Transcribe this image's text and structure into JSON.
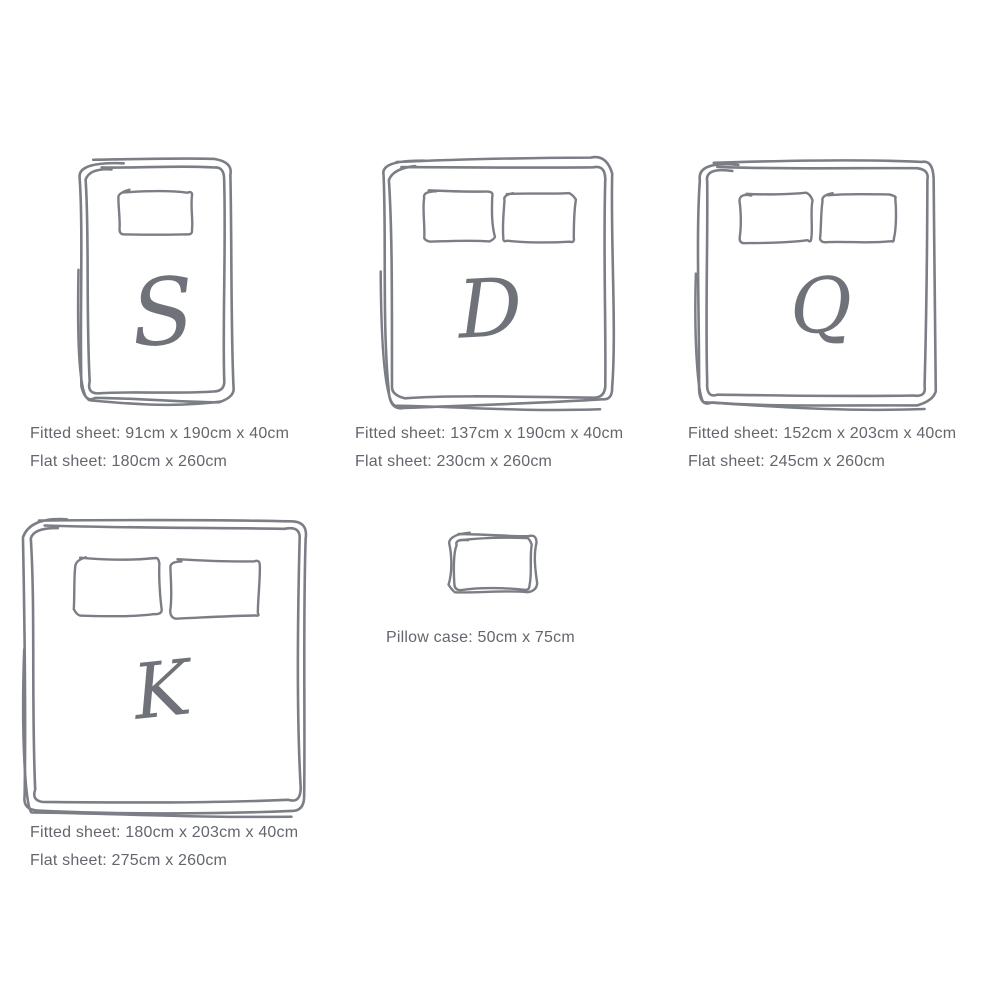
{
  "page": {
    "background": "#ffffff",
    "sketch_color": "#7b7e85",
    "letter_color": "#6f7278",
    "text_color": "#63676d"
  },
  "sizes": [
    {
      "id": "single",
      "letter": "S",
      "pillows": 1,
      "fitted_sheet_label": "Fitted sheet: 91cm x 190cm x 40cm",
      "flat_sheet_label": "Flat sheet: 180cm x 260cm"
    },
    {
      "id": "double",
      "letter": "D",
      "pillows": 2,
      "fitted_sheet_label": "Fitted sheet: 137cm x 190cm x 40cm",
      "flat_sheet_label": "Flat sheet: 230cm x 260cm"
    },
    {
      "id": "queen",
      "letter": "Q",
      "pillows": 2,
      "fitted_sheet_label": "Fitted sheet: 152cm x 203cm x 40cm",
      "flat_sheet_label": "Flat sheet: 245cm x 260cm"
    },
    {
      "id": "king",
      "letter": "K",
      "pillows": 2,
      "fitted_sheet_label": "Fitted sheet: 180cm x 203cm x 40cm",
      "flat_sheet_label": "Flat sheet: 275cm x 260cm"
    }
  ],
  "pillow_case": {
    "label": "Pillow case: 50cm x 75cm"
  }
}
